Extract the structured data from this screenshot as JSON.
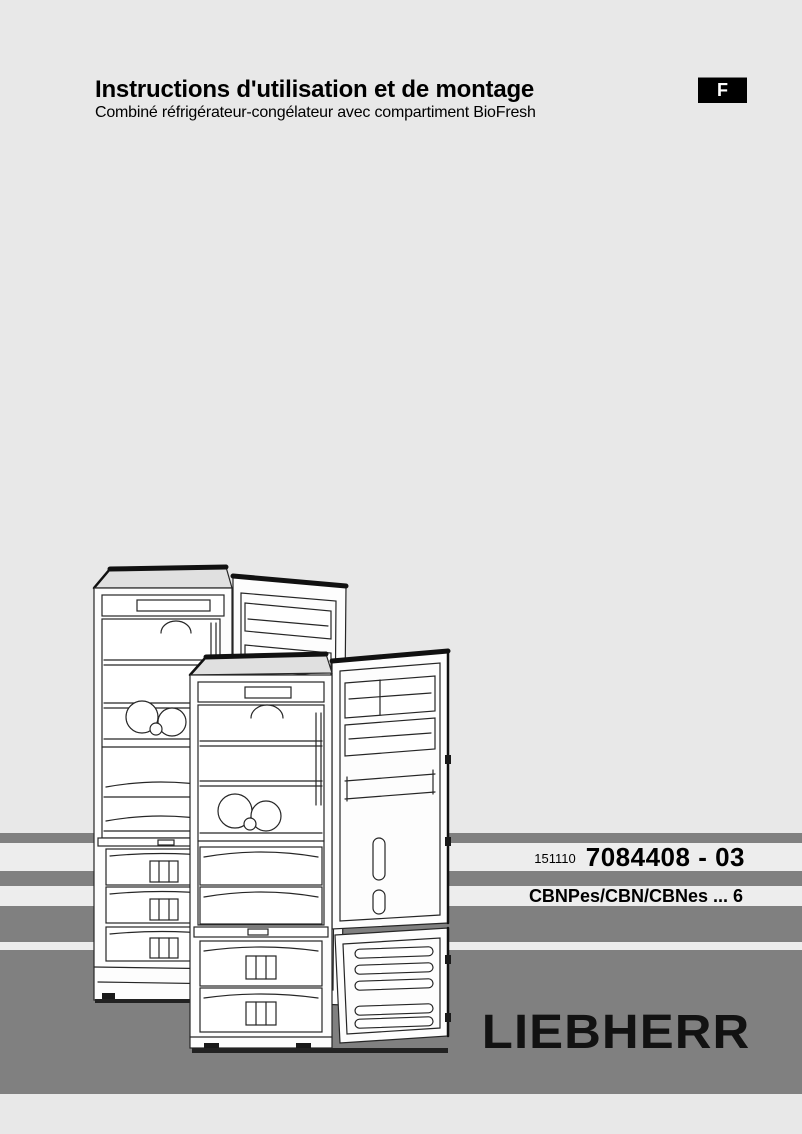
{
  "page": {
    "background": "#e8e8e8",
    "stripe_color": "#808080",
    "band_color": "#ededed",
    "text_color": "#000000"
  },
  "header": {
    "title": "Instructions d'utilisation et de montage",
    "subtitle": "Combiné réfrigérateur-congélateur avec compartiment BioFresh",
    "language_badge": "F"
  },
  "order_info": {
    "date_code": "151110",
    "part_number": "7084408 - 03",
    "model_range": "CBNPes/CBN/CBNes ... 6"
  },
  "brand": {
    "logo_text": "LIEBHERR",
    "logo_color": "#121212"
  },
  "illustration": {
    "name": "fridge-freezer-line-art",
    "description": "Two overlapping combination refrigerator-freezers with open doors"
  }
}
